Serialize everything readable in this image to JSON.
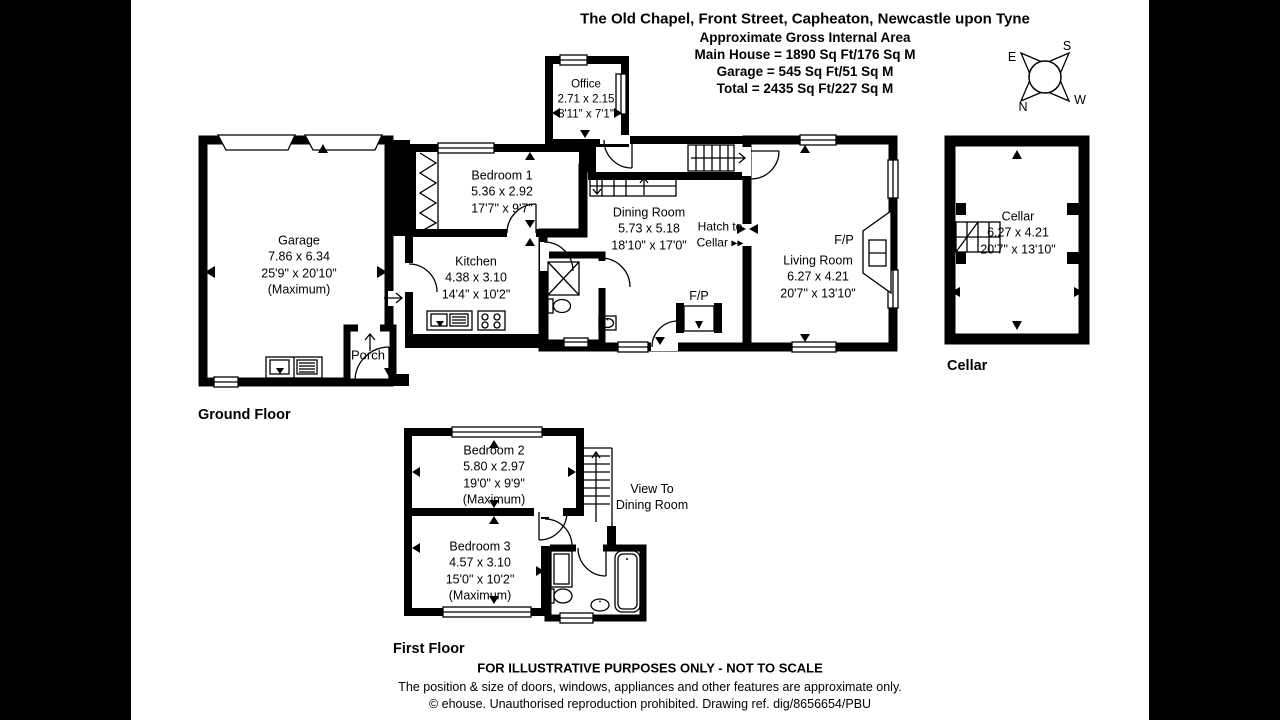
{
  "header": {
    "title": "The Old Chapel, Front Street, Capheaton, Newcastle upon Tyne",
    "subtitle": "Approximate Gross Internal Area",
    "line1": "Main House = 1890 Sq Ft/176 Sq M",
    "line2": "Garage = 545 Sq Ft/51 Sq M",
    "line3": "Total = 2435 Sq Ft/227 Sq M"
  },
  "compass": {
    "north": "N",
    "south": "S",
    "east": "E",
    "west": "W"
  },
  "floor_labels": {
    "ground": "Ground Floor",
    "first": "First Floor",
    "cellar": "Cellar"
  },
  "rooms": {
    "garage": {
      "name": "Garage",
      "metric": "7.86 x 6.34",
      "imperial": "25'9\" x 20'10\"",
      "note": "(Maximum)"
    },
    "porch": {
      "name": "Porch"
    },
    "office": {
      "name": "Office",
      "metric": "2.71 x 2.15",
      "imperial": "8'11\" x 7'1\""
    },
    "bedroom1": {
      "name": "Bedroom 1",
      "metric": "5.36 x 2.92",
      "imperial": "17'7\" x 9'7\""
    },
    "kitchen": {
      "name": "Kitchen",
      "metric": "4.38 x 3.10",
      "imperial": "14'4\" x 10'2\""
    },
    "dining": {
      "name": "Dining Room",
      "metric": "5.73 x 5.18",
      "imperial": "18'10\" x 17'0\""
    },
    "living": {
      "name": "Living Room",
      "metric": "6.27 x 4.21",
      "imperial": "20'7\" x 13'10\""
    },
    "cellar": {
      "name": "Cellar",
      "metric": "6.27 x 4.21",
      "imperial": "20'7\" x 13'10\""
    },
    "bedroom2": {
      "name": "Bedroom 2",
      "metric": "5.80 x 2.97",
      "imperial": "19'0\" x 9'9\"",
      "note": "(Maximum)"
    },
    "bedroom3": {
      "name": "Bedroom 3",
      "metric": "4.57 x 3.10",
      "imperial": "15'0\" x 10'2\"",
      "note": "(Maximum)"
    }
  },
  "annotations": {
    "fireplace_dining": "F/P",
    "fireplace_living": "F/P",
    "hatch_line1": "Hatch to",
    "hatch_line2": "Cellar",
    "hatch_arrows": "▸▸",
    "view_line1": "View To",
    "view_line2": "Dining Room"
  },
  "footer": {
    "line1": "FOR ILLUSTRATIVE PURPOSES ONLY - NOT TO SCALE",
    "line2": "The position & size of doors, windows, appliances and other features are approximate only.",
    "line3": "© ehouse. Unauthorised reproduction prohibited. Drawing ref. dig/8656654/PBU"
  },
  "colors": {
    "wall": "#000000",
    "paper": "#ffffff",
    "letterbox": "#000000"
  }
}
